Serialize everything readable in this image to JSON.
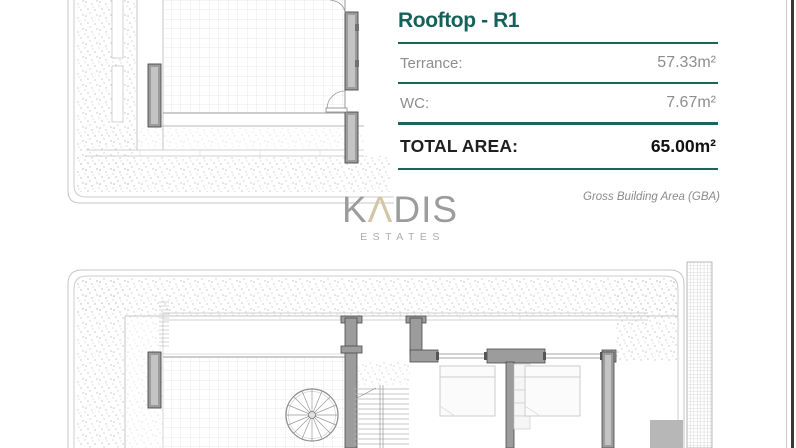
{
  "theme": {
    "accent": "#1b655f",
    "title_color": "#17615b",
    "label_gray": "#8d8d8d",
    "footnote_gray": "#8a8a8a",
    "logo_gray": "#9c9c9c",
    "logo_accent": "#d3c6a4",
    "edge_dark": "#383838"
  },
  "panel": {
    "title": "Rooftop - R1",
    "rows": [
      {
        "label": "Terrance:",
        "value": "57.33m²"
      },
      {
        "label": "WC:",
        "value": "7.67m²"
      }
    ],
    "total": {
      "label": "TOTAL AREA:",
      "value": "65.00m²"
    }
  },
  "footnote": "Gross Building Area (GBA)",
  "logo": {
    "part1": "K",
    "part2": "Λ",
    "part3": "DIS",
    "subtitle": "ESTATES"
  }
}
